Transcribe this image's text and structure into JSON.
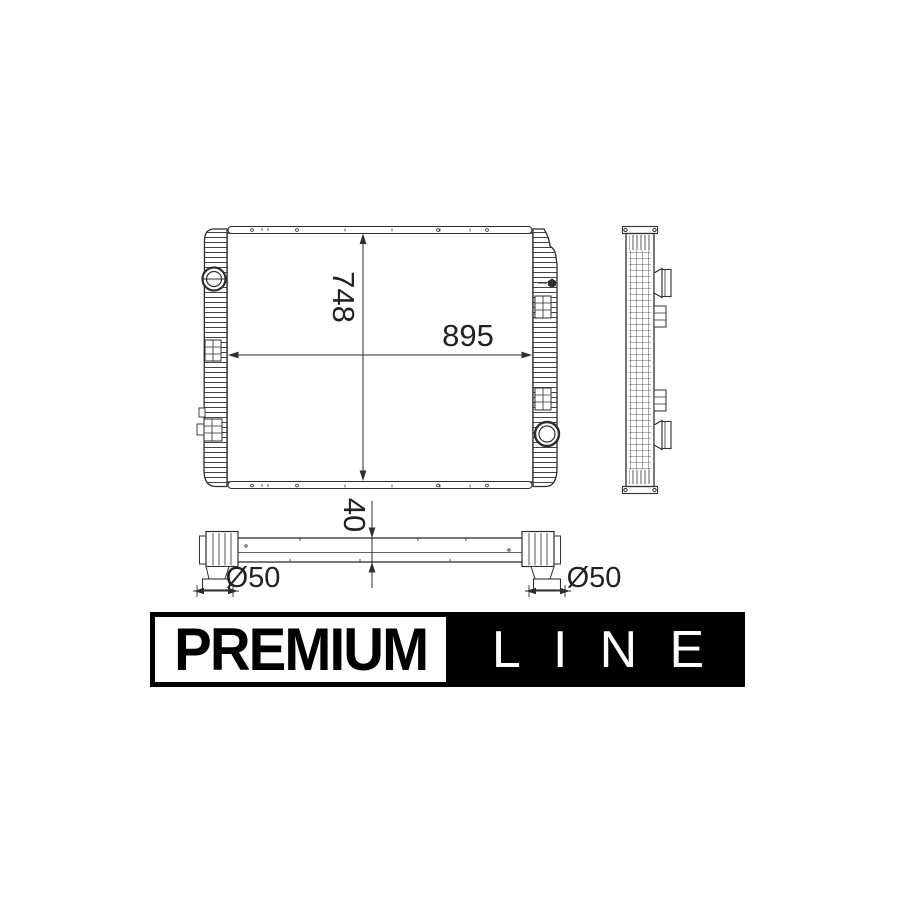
{
  "drawing": {
    "dim_height": "748",
    "dim_width": "895",
    "dim_depth": "40",
    "dim_pipe_left": "Ø50",
    "dim_pipe_right": "Ø50"
  },
  "banner": {
    "premium": "PREMIUM",
    "line": "LINE"
  },
  "colors": {
    "background": "#ffffff",
    "line_art": "#2e2e2e",
    "label_text": "#222222",
    "banner_bg": "#000000",
    "banner_premium_bg": "#ffffff"
  }
}
